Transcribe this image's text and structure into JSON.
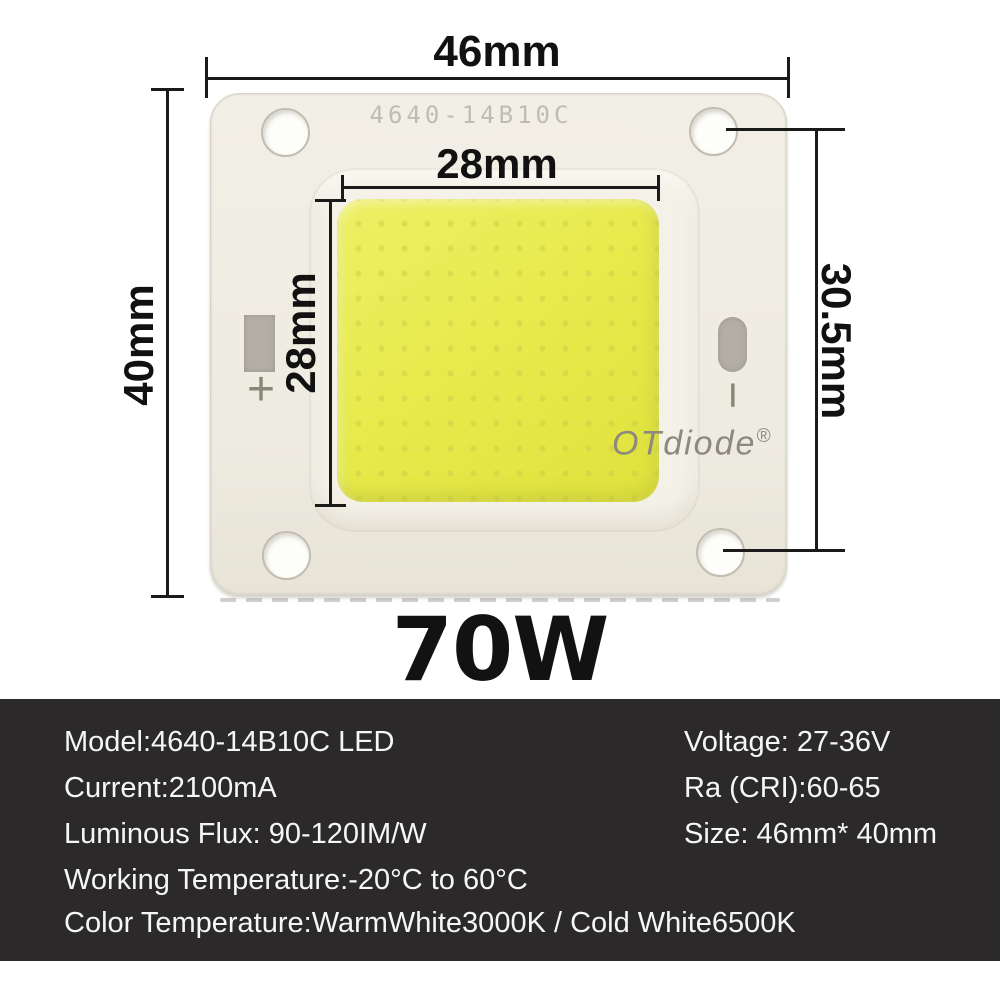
{
  "power_label": "70W",
  "annotations": {
    "total_width": "46mm",
    "total_height": "40mm",
    "emitter_width": "28mm",
    "emitter_height": "28mm",
    "hole_span": "30.5mm"
  },
  "chip": {
    "top_label": "4640-14B10C",
    "brand": "OTdiode",
    "brand_mark": "®",
    "positive_symbol": "+",
    "negative_symbol": "−"
  },
  "specs": {
    "rows": [
      {
        "left": "Model:4640-14B10C LED",
        "right": "Voltage: 27-36V"
      },
      {
        "left": "Current:2100mA",
        "right": "Ra (CRI):60-65"
      },
      {
        "left": "Luminous Flux: 90-120IM/W",
        "right": "Size: 46mm* 40mm"
      },
      {
        "left": "Working Temperature:-20°C to 60°C"
      },
      {
        "left": "Color Temperature:WarmWhite3000K / Cold White6500K"
      }
    ]
  },
  "colors": {
    "panel_bg": "#2b2929",
    "panel_text": "#f6f6f6",
    "emitter_yellow": "#e8ea4d",
    "plate_white": "#f0ede3",
    "pad_gray": "#b3afa5",
    "dimension_line": "#1a1a1a",
    "chip_print_gray": "#c0bcb0"
  }
}
